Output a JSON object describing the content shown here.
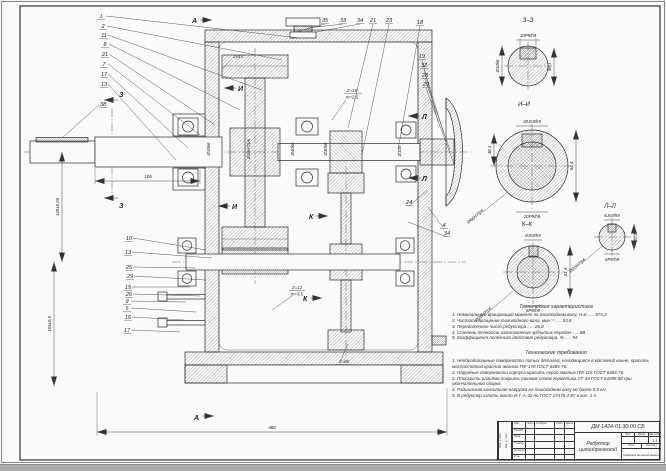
{
  "titleblock": {
    "doc_number": "ДМ 1424-01.30.00 СБ",
    "name1": "Редуктор",
    "name2": "цилиндрический",
    "scale_value": "1:1",
    "col_izm": "Изм.",
    "col_list": "Лист",
    "col_doc": "№ докум.",
    "col_podp": "Подп.",
    "col_data": "Дата",
    "row_razrab": "Разраб.",
    "row_prov": "Пров.",
    "row_tkontr": "Т.контр.",
    "row_nkontr": "Н.контр.",
    "row_utv": "Утв.",
    "lit": "Лит.",
    "massa": "Масса",
    "masshtab": "Масштаб",
    "list_label": "Лист",
    "listov_label": "Листов 1",
    "org": "Кафедра деталей машин",
    "stamp1": "Подп. и дата",
    "stamp2": "Инв. № подл."
  },
  "tech_char": {
    "title": "Техническая характеристика",
    "items": [
      "1. Номинальный вращающий момент на тихоходном валу, Н·м ..... 874,3",
      "2. Частота вращения тихоходного вала, мин⁻¹ ..... 53,8",
      "3. Передаточное число редуктора ..... 26,8",
      "4. Степень точности изготовления зубчатых передач ..... 8В",
      "5. Коэффициент полезного действия редуктора, % ..... 94"
    ]
  },
  "tech_req": {
    "title": "Технические требования",
    "items": [
      "1. Необработанные поверхности литых деталей, находящиеся в масляной ванне, красить маслостойкой красной эмалью ПФ-170 ГОСТ 6465-76.",
      "2. Наружные поверхности корпуса красить серой эмалью ПФ-115 ГОСТ 6465-76.",
      "3. Плоскость разъёма покрыть тонким слоем герметика УТ-34 ГОСТ 24285-80 при окончательной сборке.",
      "4. Радиальная консольная нагрузка на тихоходном валу не более 0,5 кН.",
      "5. В редуктор залить масло И-Г-А-32 по ГОСТ 17479.4-87 в кол. 2 л."
    ]
  },
  "sections": {
    "zz": {
      "title": "З–З",
      "top": "10P9/h9",
      "left": "Ø34k6",
      "right": "38,1"
    },
    "ii": {
      "title": "И–И",
      "top": "20Js9/h9",
      "bottom": "20P9/h9",
      "left": "48,1",
      "right": "64,4",
      "diag": "Ø60H7/p6"
    },
    "kk": {
      "title": "К–К",
      "top": "8Js9/h9",
      "bottom": "8P9/h9",
      "right": "31,4",
      "diag": "Ø28H7/p6"
    },
    "ll": {
      "title": "Л–Л",
      "top": "6Js9/h9",
      "bottom": "6P9/h9",
      "right": "22,8",
      "diag": "Ø20H7/p6"
    }
  },
  "dims": {
    "overall": "460",
    "shaft": "106",
    "axis1": "140±0,05",
    "axis2": "165±0,5",
    "chamfer": "2×45°",
    "coupling": "Ø100",
    "fit1": "Ø35k6",
    "fit2": "Ø45H7/p6",
    "fit3": "Ø40k6",
    "fit4": "Ø30k6"
  },
  "gears": {
    "g1": "Z=18",
    "g1m": "m=2,5",
    "g2": "Z=12",
    "g2m": "m=3,5",
    "g3": "Z=80"
  },
  "marks": {
    "a": "А",
    "z": "З",
    "i": "И",
    "k": "К",
    "l": "Л"
  },
  "callouts": [
    "1",
    "2",
    "11",
    "8",
    "21",
    "7",
    "17",
    "13",
    "38",
    "35",
    "33",
    "34",
    "21",
    "23",
    "18",
    "19",
    "32",
    "28",
    "29",
    "24",
    "4",
    "34",
    "10",
    "13",
    "25",
    "29",
    "15",
    "26",
    "9",
    "5",
    "16",
    "17"
  ]
}
